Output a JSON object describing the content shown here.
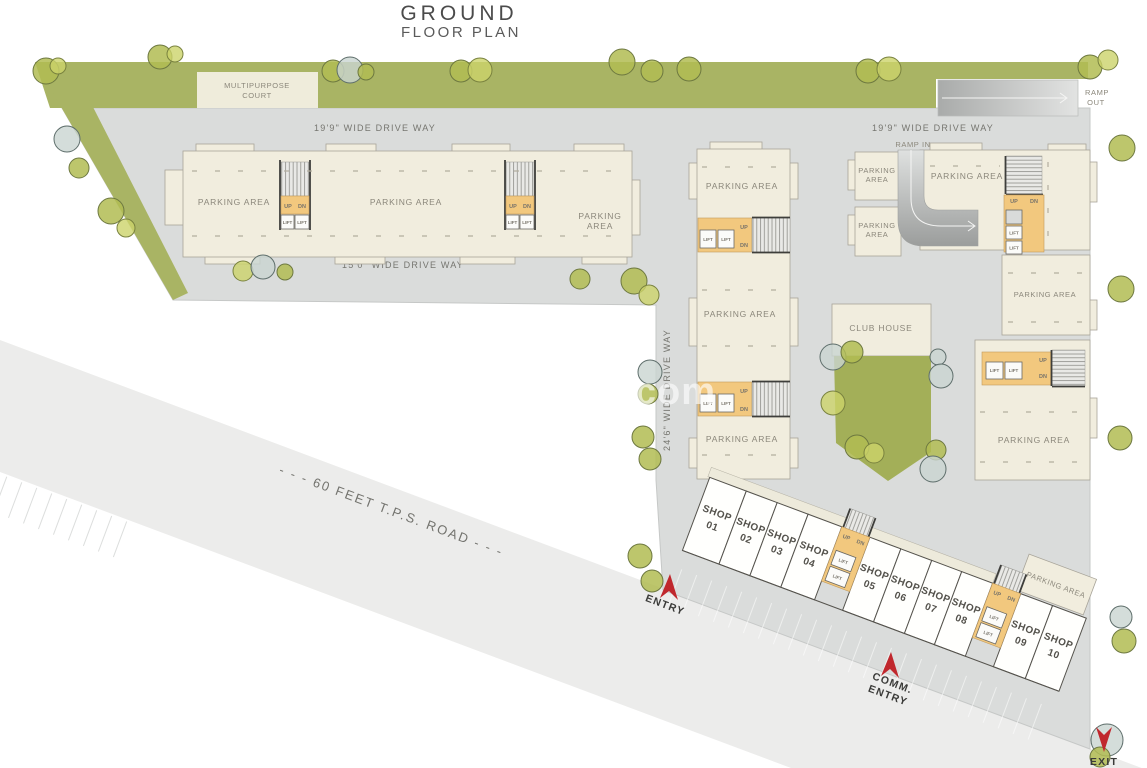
{
  "title": {
    "line1": "GROUND",
    "line2": "FLOOR PLAN"
  },
  "watermark": "EasyProps.com",
  "road_label": "- - - 60 FEET T.P.S. ROAD - - -",
  "driveways": {
    "w199": "19'9\"  WIDE  DRIVE WAY",
    "w150": "15'0\"  WIDE  DRIVE WAY",
    "w246": "24'6\"  WIDE  DRIVE WAY"
  },
  "ramps": {
    "ramp_in": "RAMP IN",
    "ramp_out_line1": "RAMP",
    "ramp_out_line2": "OUT"
  },
  "court": {
    "line1": "MULTIPURPOSE",
    "line2": "COURT"
  },
  "club_house": "CLUB HOUSE",
  "parking_area": "PARKING AREA",
  "parking_word": "PARKING",
  "area_word": "AREA",
  "core": {
    "up": "UP",
    "dn": "DN",
    "lift": "LIFT"
  },
  "entries": {
    "entry": "ENTRY",
    "comm_line1": "COMM.",
    "comm_line2": "ENTRY",
    "exit": "EXIT"
  },
  "shops": {
    "word": "SHOP",
    "numbers": [
      "01",
      "02",
      "03",
      "04",
      "05",
      "06",
      "07",
      "08",
      "09",
      "10"
    ]
  },
  "colors": {
    "green": "#a9b464",
    "site_gray": "#dadcdb",
    "road_gray": "#ececeb",
    "building_cream": "#f1edde",
    "core_orange": "#f2c87e",
    "arrow_red": "#c0272d"
  }
}
